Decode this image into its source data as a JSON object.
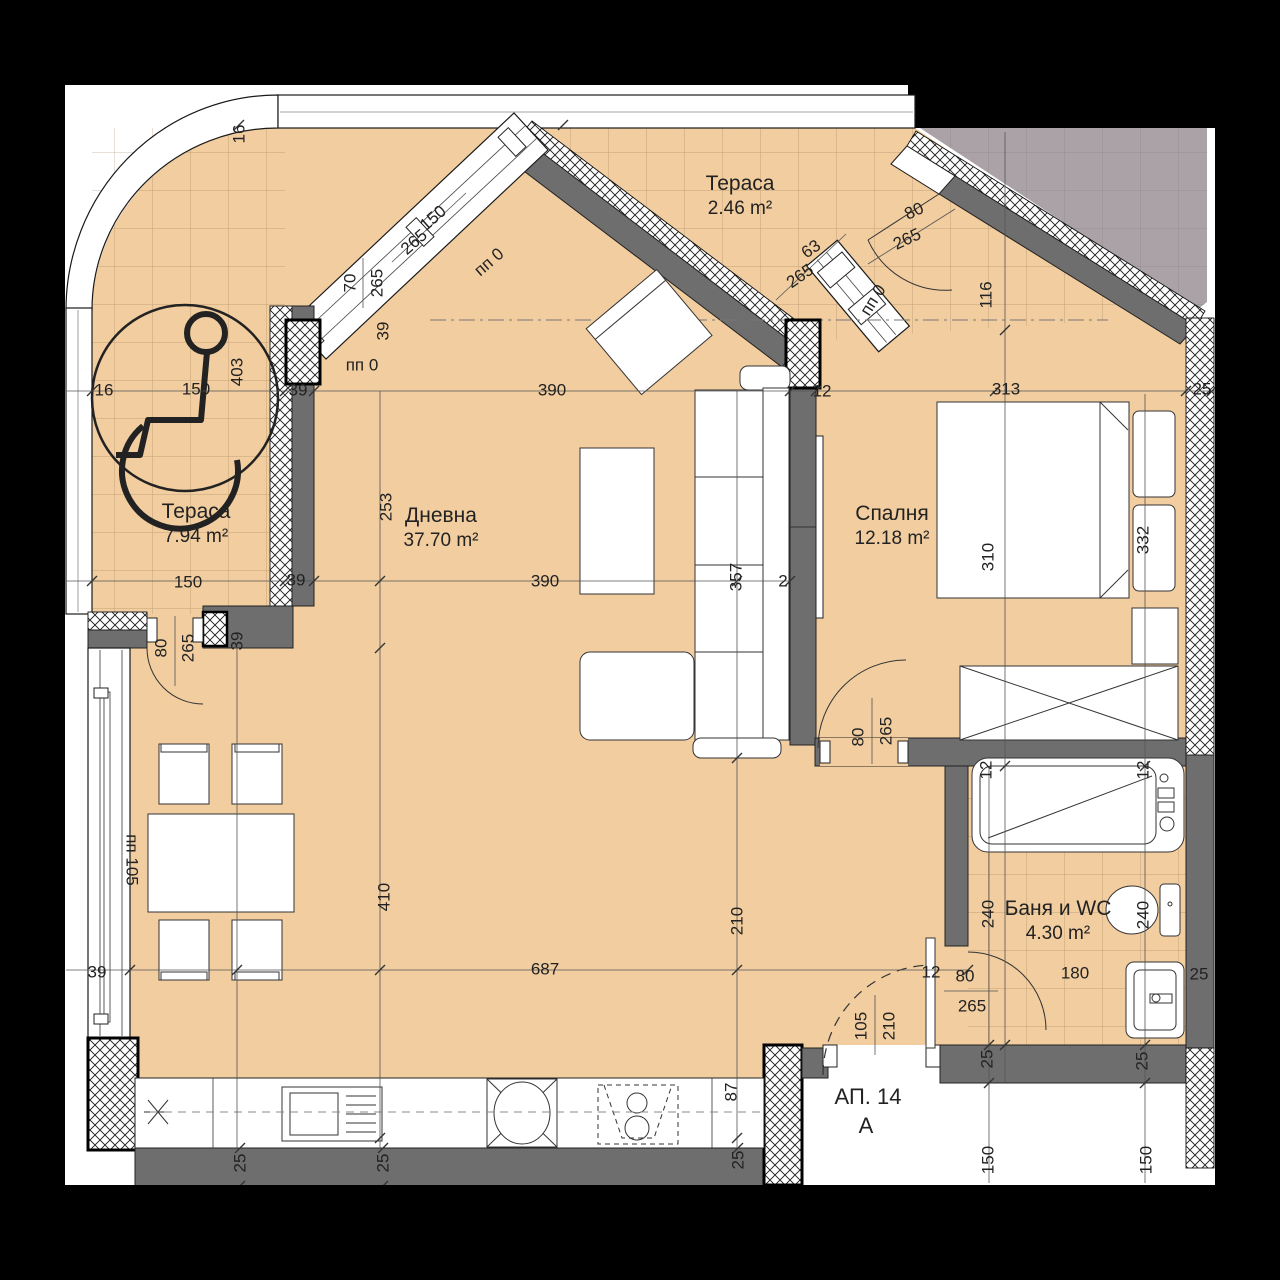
{
  "plan": {
    "apartment": {
      "number": "АП. 14",
      "section": "А"
    },
    "rooms": [
      {
        "name": "Тераса",
        "area": "2.46 m²",
        "x": 740,
        "y": 196
      },
      {
        "name": "Тераса",
        "area": "7.94 m²",
        "x": 196,
        "y": 524
      },
      {
        "name": "Дневна",
        "area": "37.70 m²",
        "x": 441,
        "y": 528
      },
      {
        "name": "Спалня",
        "area": "12.18 m²",
        "x": 892,
        "y": 526
      },
      {
        "name": "Баня и WC",
        "area": "4.30 m²",
        "x": 1058,
        "y": 921
      }
    ],
    "dims": [
      {
        "t": "16",
        "x": 239,
        "y": 134,
        "r": -90
      },
      {
        "t": "16",
        "x": 104,
        "y": 390,
        "r": 0
      },
      {
        "t": "150",
        "x": 196,
        "y": 389,
        "r": 0
      },
      {
        "t": "39",
        "x": 298,
        "y": 390,
        "r": 0
      },
      {
        "t": "403",
        "x": 237,
        "y": 372,
        "r": -90
      },
      {
        "t": "150",
        "x": 433,
        "y": 218,
        "r": -41
      },
      {
        "t": "265",
        "x": 414,
        "y": 242,
        "r": -41
      },
      {
        "t": "пп 0",
        "x": 489,
        "y": 262,
        "r": -41
      },
      {
        "t": "70",
        "x": 350,
        "y": 283,
        "r": -90
      },
      {
        "t": "265",
        "x": 377,
        "y": 283,
        "r": -90
      },
      {
        "t": "39",
        "x": 383,
        "y": 331,
        "r": -90
      },
      {
        "t": "пп 0",
        "x": 362,
        "y": 365,
        "r": 0
      },
      {
        "t": "63",
        "x": 811,
        "y": 249,
        "r": -35
      },
      {
        "t": "265",
        "x": 800,
        "y": 276,
        "r": -35
      },
      {
        "t": "пп 0",
        "x": 873,
        "y": 300,
        "r": -58
      },
      {
        "t": "80",
        "x": 914,
        "y": 211,
        "r": -25
      },
      {
        "t": "265",
        "x": 907,
        "y": 239,
        "r": -25
      },
      {
        "t": "116",
        "x": 986,
        "y": 295,
        "r": -90
      },
      {
        "t": "313",
        "x": 1006,
        "y": 389,
        "r": 0
      },
      {
        "t": "25",
        "x": 1202,
        "y": 389,
        "r": 0
      },
      {
        "t": "390",
        "x": 552,
        "y": 390,
        "r": 0
      },
      {
        "t": "12",
        "x": 822,
        "y": 391,
        "r": 0
      },
      {
        "t": "253",
        "x": 386,
        "y": 507,
        "r": -90
      },
      {
        "t": "390",
        "x": 545,
        "y": 581,
        "r": 0
      },
      {
        "t": "2",
        "x": 783,
        "y": 581,
        "r": 0
      },
      {
        "t": "357",
        "x": 736,
        "y": 577,
        "r": -90
      },
      {
        "t": "310",
        "x": 988,
        "y": 557,
        "r": -90
      },
      {
        "t": "332",
        "x": 1143,
        "y": 540,
        "r": -90
      },
      {
        "t": "150",
        "x": 188,
        "y": 582,
        "r": 0
      },
      {
        "t": "39",
        "x": 296,
        "y": 580,
        "r": 0
      },
      {
        "t": "80",
        "x": 161,
        "y": 648,
        "r": -90
      },
      {
        "t": "265",
        "x": 188,
        "y": 648,
        "r": -90
      },
      {
        "t": "39",
        "x": 237,
        "y": 641,
        "r": -90
      },
      {
        "t": "пп 105",
        "x": 132,
        "y": 860,
        "r": 90
      },
      {
        "t": "39",
        "x": 97,
        "y": 972,
        "r": 0
      },
      {
        "t": "410",
        "x": 384,
        "y": 897,
        "r": -90
      },
      {
        "t": "210",
        "x": 737,
        "y": 921,
        "r": -90
      },
      {
        "t": "687",
        "x": 545,
        "y": 969,
        "r": 0
      },
      {
        "t": "240",
        "x": 988,
        "y": 914,
        "r": -90
      },
      {
        "t": "240",
        "x": 1143,
        "y": 915,
        "r": -90
      },
      {
        "t": "180",
        "x": 1075,
        "y": 973,
        "r": 0
      },
      {
        "t": "12",
        "x": 986,
        "y": 770,
        "r": -90
      },
      {
        "t": "12",
        "x": 1143,
        "y": 770,
        "r": -90
      },
      {
        "t": "12",
        "x": 931,
        "y": 972,
        "r": 0
      },
      {
        "t": "80",
        "x": 965,
        "y": 976,
        "r": 0
      },
      {
        "t": "265",
        "x": 972,
        "y": 1006,
        "r": 0
      },
      {
        "t": "105",
        "x": 861,
        "y": 1026,
        "r": -90
      },
      {
        "t": "210",
        "x": 889,
        "y": 1026,
        "r": -90
      },
      {
        "t": "80",
        "x": 858,
        "y": 737,
        "r": -90
      },
      {
        "t": "265",
        "x": 886,
        "y": 731,
        "r": -90
      },
      {
        "t": "25",
        "x": 240,
        "y": 1163,
        "r": -90
      },
      {
        "t": "25",
        "x": 383,
        "y": 1163,
        "r": -90
      },
      {
        "t": "25",
        "x": 738,
        "y": 1160,
        "r": -90
      },
      {
        "t": "87",
        "x": 731,
        "y": 1092,
        "r": -90
      },
      {
        "t": "25",
        "x": 987,
        "y": 1059,
        "r": -90
      },
      {
        "t": "25",
        "x": 1142,
        "y": 1061,
        "r": -90
      },
      {
        "t": "150",
        "x": 988,
        "y": 1160,
        "r": -90
      },
      {
        "t": "150",
        "x": 1146,
        "y": 1160,
        "r": -90
      },
      {
        "t": "25",
        "x": 1199,
        "y": 974,
        "r": 0
      }
    ],
    "colors": {
      "floor": "#f1cda0",
      "wall": "#6e6e6e",
      "neighbor": "#aaa2a7",
      "page": "#ffffff",
      "background": "#000000"
    }
  }
}
